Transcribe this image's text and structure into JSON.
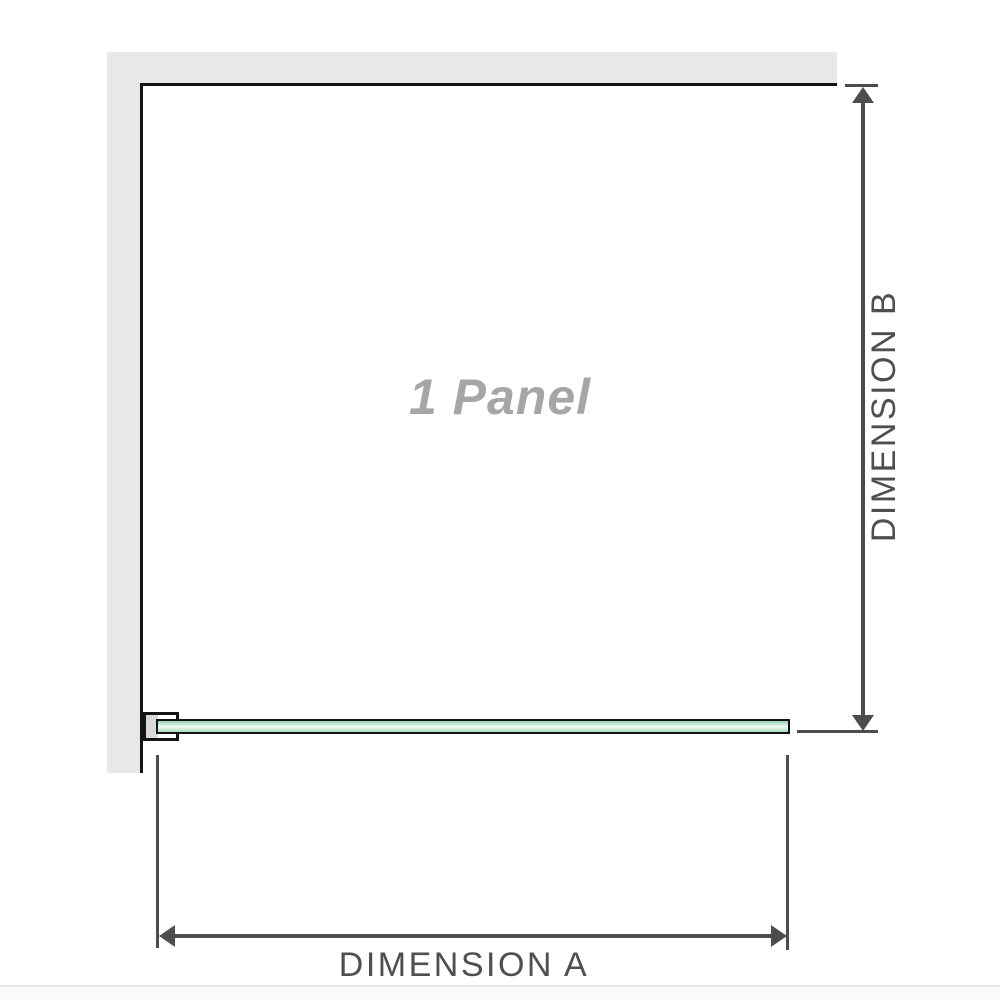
{
  "diagram": {
    "panel_label": "1 Panel",
    "dimension_a_label": "DIMENSION A",
    "dimension_b_label": "DIMENSION B"
  },
  "icons": {
    "dimension_b": [
      "arrow-up-icon",
      "arrow-down-icon"
    ],
    "dimension_a": [
      "arrow-left-icon",
      "arrow-right-icon"
    ]
  },
  "colors": {
    "wall_fill": "#e8e8e8",
    "outline_black": "#141414",
    "glass_green_dark": "#8fcfae",
    "glass_green_light": "#e4f6ec",
    "glass_green_mid": "#a5dabf",
    "bracket_pad_gray": "#d8d8d8",
    "dimension_line": "#4d4d4d",
    "dimension_label_text": "#4f4f4f",
    "panel_label_text": "#a6a6a6",
    "baseline_line": "#e7e4df"
  }
}
